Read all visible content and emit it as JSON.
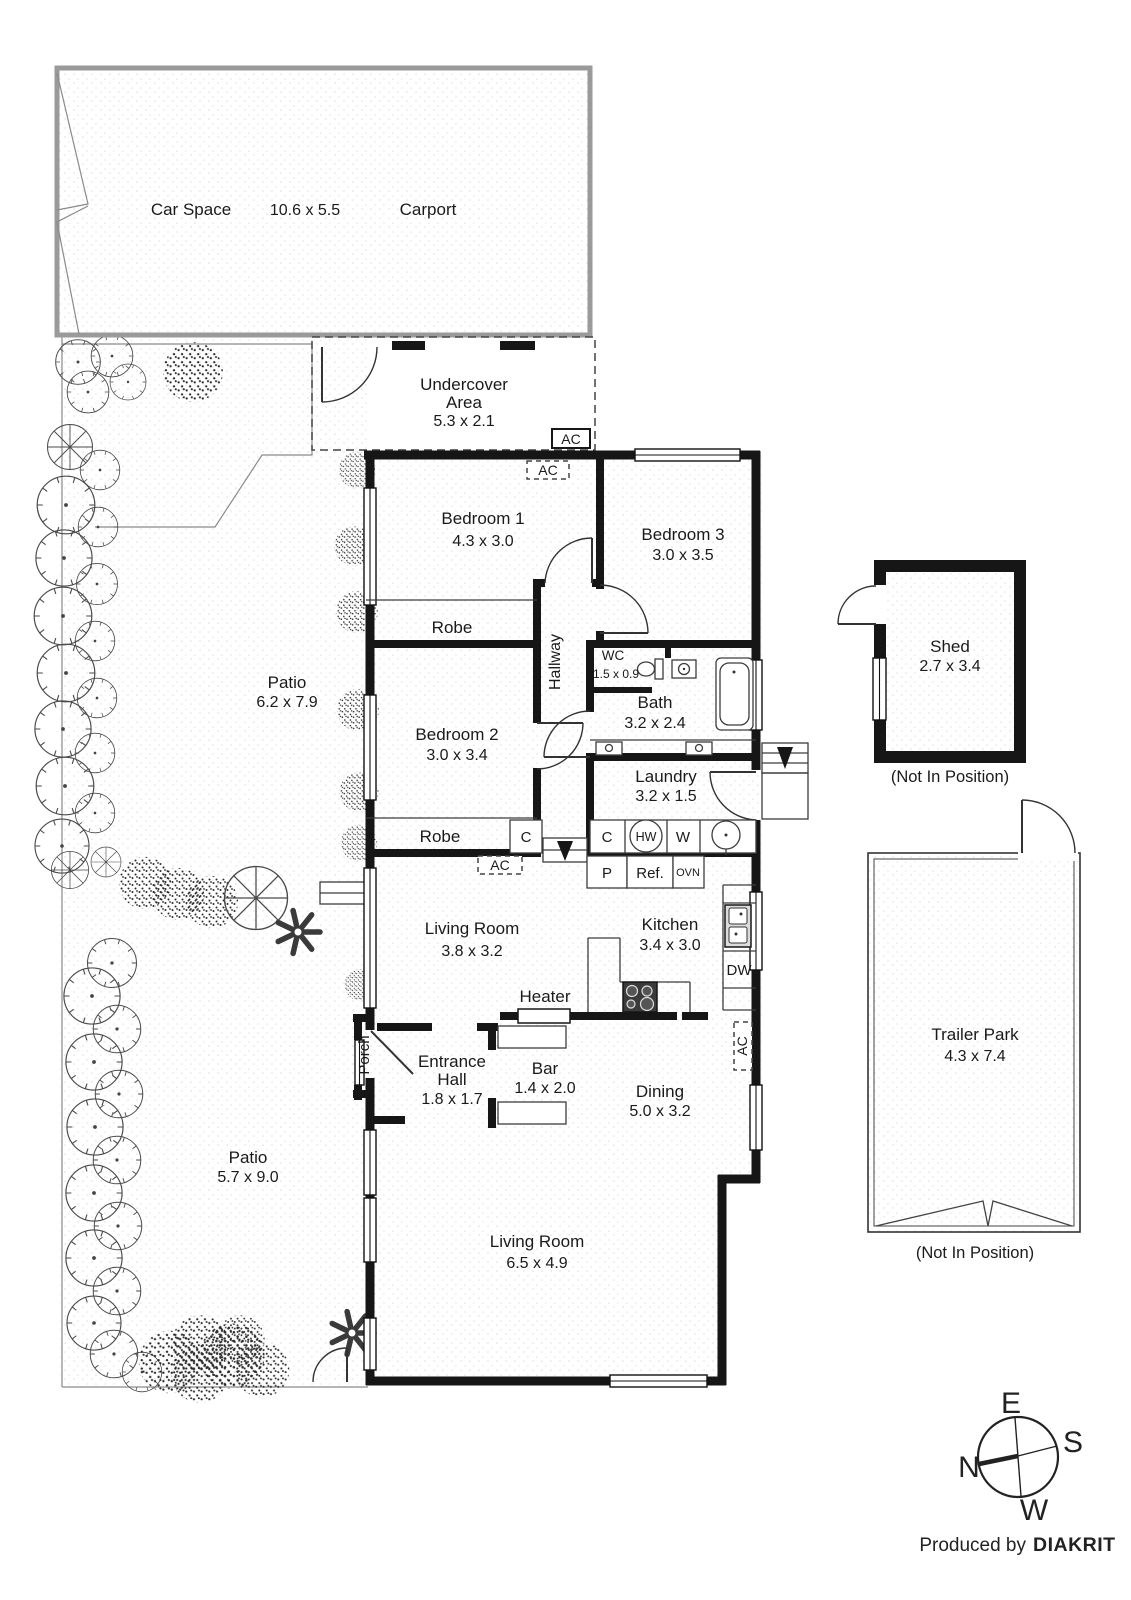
{
  "plan": {
    "carport": {
      "car_space": "Car Space",
      "dims": "10.6 x 5.5",
      "carport": "Carport"
    },
    "undercover": {
      "l1": "Undercover",
      "l2": "Area",
      "dims": "5.3 x 2.1"
    },
    "ac": "AC",
    "bed1": {
      "name": "Bedroom 1",
      "dims": "4.3 x 3.0"
    },
    "bed3": {
      "name": "Bedroom 3",
      "dims": "3.0 x 3.5"
    },
    "bed2": {
      "name": "Bedroom 2",
      "dims": "3.0 x 3.4"
    },
    "robe1": "Robe",
    "robe2": "Robe",
    "hallway": "Hallway",
    "wc": {
      "name": "WC",
      "dims": "1.5 x 0.9"
    },
    "bath": {
      "name": "Bath",
      "dims": "3.2 x 2.4"
    },
    "laundry": {
      "name": "Laundry",
      "dims": "3.2 x 1.5"
    },
    "living1": {
      "name": "Living Room",
      "dims": "3.8 x 3.2"
    },
    "kitchen": {
      "name": "Kitchen",
      "dims": "3.4 x 3.0"
    },
    "heater": "Heater",
    "porch": "Porch",
    "entrance": {
      "l1": "Entrance",
      "l2": "Hall",
      "dims": "1.8 x 1.7"
    },
    "bar": {
      "name": "Bar",
      "dims": "1.4 x 2.0"
    },
    "dining": {
      "name": "Dining",
      "dims": "5.0 x 3.2"
    },
    "living2": {
      "name": "Living Room",
      "dims": "6.5 x 4.9"
    },
    "patio1": {
      "name": "Patio",
      "dims": "6.2 x 7.9"
    },
    "patio2": {
      "name": "Patio",
      "dims": "5.7 x 9.0"
    },
    "fixtures": {
      "c_hall": "C",
      "c_laundry": "C",
      "hw": "HW",
      "w": "W",
      "p": "P",
      "ref": "Ref.",
      "ovn": "OVN",
      "dw": "DW"
    },
    "shed": {
      "name": "Shed",
      "dims": "2.7 x 3.4",
      "note": "(Not In Position)"
    },
    "trailer": {
      "name": "Trailer Park",
      "dims": "4.3 x 7.4",
      "note": "(Not In Position)"
    },
    "compass": {
      "e": "E",
      "s": "S",
      "n": "N",
      "w": "W"
    },
    "footer": {
      "prefix": "Produced by",
      "brand": "DIAKRIT"
    }
  },
  "colors": {
    "walls": "#161616",
    "thin_lines": "#3c3c3c",
    "background": "#ffffff"
  }
}
